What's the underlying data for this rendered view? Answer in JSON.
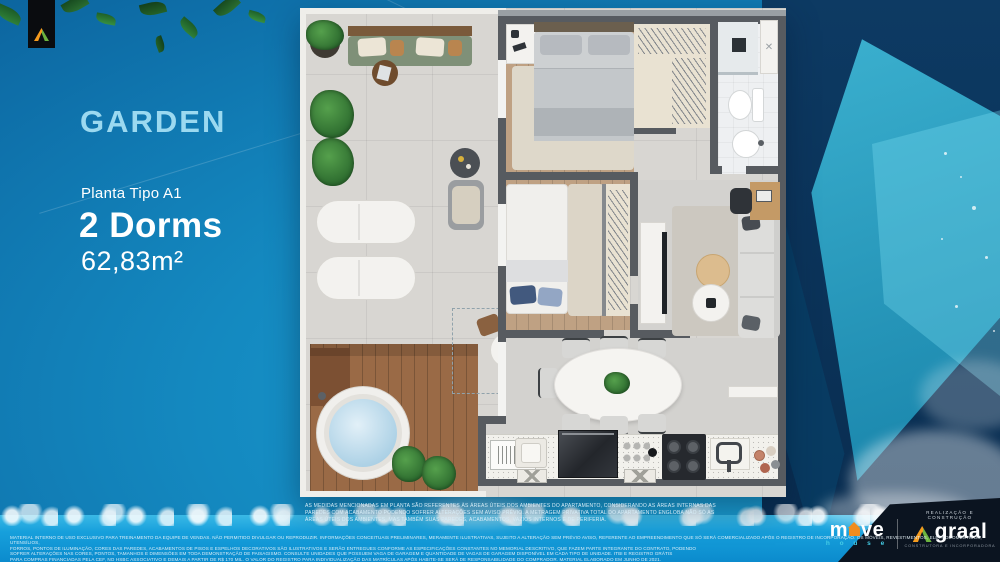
{
  "title_panel": {
    "title": "GARDEN",
    "plan_label": "Planta Tipo A1",
    "dorms": "2 Dorms",
    "area": "62,83m²"
  },
  "note_lines": [
    "AS MEDIDAS MENCIONADAS EM PLANTA SÃO REFERENTES ÀS ÁREAS ÚTEIS DOS AMBIENTES DO APARTAMENTO, CONSIDERANDO AS ÁREAS INTERNAS DAS",
    "PAREDES COM ACABAMENTO PODENDO SOFRER ALTERAÇÕES SEM AVISO PRÉVIO. A METRAGEM PRIVATIVA TOTAL DO APARTAMENTO ENGLOBA NÃO SÓ AS",
    "ÁREAS ÚTEIS DOS AMBIENTES, MAS TAMBÉM SUAS PAREDES, ACABAMENTOS, VAZIOS INTERNOS E DE PERIFERIA."
  ],
  "legal_lines": [
    "MATERIAL INTERNO DE USO EXCLUSIVO PARA TREINAMENTO DA EQUIPE DE VENDAS. NÃO PERMITIDO DIVULGAR OU REPRODUZIR. INFORMAÇÕES CONCEITUAIS PRELIMINARES, MERAMENTE ILUSTRATIVAS, SUJEITO A ALTERAÇÃO SEM PRÉVIO AVISO, REFERENTE AO EMPREENDIMENTO QUE SÓ SERÁ COMERCIALIZADO APÓS O REGISTRO DE INCORPORAÇÃO. OS MÓVEIS, REVESTIMENTOS, ELETRODOMÉSTICOS, UTENSÍLIOS,",
    "FORROS, PONTOS DE ILUMINAÇÃO, CORES DAS PAREDES, ACABAMENTOS DE PISOS E ESPELHOS DECORATIVOS SÃO ILUSTRATIVOS E SERÃO ENTREGUES CONFORME AS ESPECIFICAÇÕES CONSTANTES NO MEMORIAL DESCRITIVO, QUE FAZEM PARTE INTEGRANTE DO CONTRATO, PODENDO",
    "SOFRER ALTERAÇÕES NAS CORES, PONTOS, TAMANHOS E DIMENSÕES EM TODA DEMONSTRAÇÃO DE PAISAGISMO. CONSULTE UNIDADES QUE POSSUEM VAGA DE GARAGEM E QUANTIDADE DE VAGAS DE GARAGEM DISPONÍVEL EM CADA TIPO DE UNIDADE. ITBI E REGISTRO GRÁTIS",
    "PARA COMPRAS FINANCIADAS PELA CEF, NO HSBC ASSOCIATIVO E DEMAIS A PARTIR DE R$ 170 MIL. O VALOR DO REGISTRO PARA INDIVIDUALIZAÇÃO DAS MATRÍCULAS APÓS HABITE-SE SERÁ DE RESPONSABILIDADE DO COMPRADOR. MATERIAL ELABORADO EM JUNHO DE 2021."
  ],
  "brands": {
    "move": {
      "prefix": "m",
      "suffix": "ve",
      "word": "h o u s e"
    },
    "graal": {
      "tagline": "REALIZAÇÃO E CONSTRUÇÃO",
      "name": "graal",
      "subtitle": "CONSTRUTORA E INCORPORADORA"
    }
  },
  "icons": {
    "move_mark": "house-icon",
    "graal_mark": "triangle-a-icon",
    "ribbon_mark": "triangle-a-icon"
  },
  "colors": {
    "accent_lightblue": "#9BD9F0",
    "background_blue": "#1489C0",
    "navy": "#0D3A63",
    "water_blue": "#17A0DC",
    "graal_orange": "#F59B1E",
    "graal_green": "#6CB33F",
    "move_orange": "#F08C1E"
  }
}
